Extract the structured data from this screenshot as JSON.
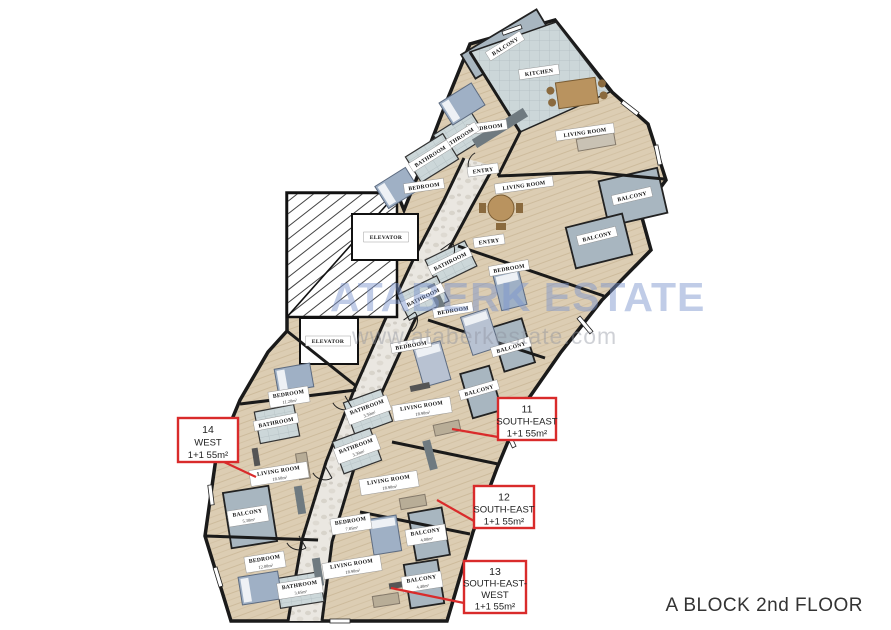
{
  "page": {
    "title": "A BLOCK 2nd FLOOR"
  },
  "watermark": {
    "line1": "ATABERK ESTATE",
    "line2": "www.ataberkestate.com"
  },
  "colors": {
    "annotation_red": "#d92b2b",
    "floor_wood": "#dccdb3",
    "balcony_gray": "#a8b6c0",
    "tile_gray": "#ccd7d9",
    "kitchen_gray": "#b9c4ca",
    "wall_black": "#1a1a1a",
    "watermark_blue": "#7c94cc"
  },
  "plan": {
    "rooms": [
      {
        "label": "BALCONY",
        "x": 505,
        "y": 46,
        "rot": -32
      },
      {
        "label": "KITCHEN",
        "x": 539,
        "y": 72,
        "rot": -8
      },
      {
        "label": "BEDROOM",
        "x": 487,
        "y": 127,
        "rot": -8
      },
      {
        "label": "BATHROOM",
        "x": 458,
        "y": 138,
        "rot": -32
      },
      {
        "label": "BATHROOM",
        "x": 430,
        "y": 156,
        "rot": -32
      },
      {
        "label": "LIVING ROOM",
        "x": 585,
        "y": 132,
        "rot": -8
      },
      {
        "label": "ENTRY",
        "x": 483,
        "y": 170,
        "rot": -8
      },
      {
        "label": "BEDROOM",
        "x": 424,
        "y": 186,
        "rot": -8
      },
      {
        "label": "LIVING ROOM",
        "x": 524,
        "y": 185,
        "rot": -8
      },
      {
        "label": "BALCONY",
        "x": 632,
        "y": 196,
        "rot": -13
      },
      {
        "label": "ELEVATOR",
        "x": 386,
        "y": 237,
        "rot": 0
      },
      {
        "label": "BALCONY",
        "x": 597,
        "y": 236,
        "rot": -14
      },
      {
        "label": "ENTRY",
        "x": 489,
        "y": 241,
        "rot": -8
      },
      {
        "label": "BATHROOM",
        "x": 450,
        "y": 261,
        "rot": -26
      },
      {
        "label": "BEDROOM",
        "x": 509,
        "y": 268,
        "rot": -10
      },
      {
        "label": "BATHROOM",
        "x": 423,
        "y": 297,
        "rot": -26
      },
      {
        "label": "BEDROOM",
        "x": 453,
        "y": 310,
        "rot": -10
      },
      {
        "label": "ELEVATOR",
        "x": 328,
        "y": 341,
        "rot": 0
      },
      {
        "label": "BEDROOM",
        "x": 411,
        "y": 345,
        "rot": -10
      },
      {
        "label": "BALCONY",
        "x": 511,
        "y": 347,
        "rot": -16
      },
      {
        "label": "BEDROOM",
        "area": "11.20m²",
        "x": 289,
        "y": 397,
        "rot": -9
      },
      {
        "label": "BALCONY",
        "x": 479,
        "y": 390,
        "rot": -16
      },
      {
        "label": "BATHROOM",
        "area": "3.50m²",
        "x": 368,
        "y": 410,
        "rot": -20
      },
      {
        "label": "LIVING ROOM",
        "area": "18.90m²",
        "x": 422,
        "y": 409,
        "rot": -9
      },
      {
        "label": "BATHROOM",
        "x": 276,
        "y": 422,
        "rot": -11
      },
      {
        "label": "BATHROOM",
        "area": "3.30m²",
        "x": 357,
        "y": 449,
        "rot": -20
      },
      {
        "label": "LIVING ROOM",
        "area": "18.50m²",
        "x": 279,
        "y": 474,
        "rot": -9
      },
      {
        "label": "LIVING ROOM",
        "area": "18.90m²",
        "x": 389,
        "y": 483,
        "rot": -9
      },
      {
        "label": "BALCONY",
        "area": "5.30m²",
        "x": 248,
        "y": 516,
        "rot": -9
      },
      {
        "label": "BEDROOM",
        "area": "7.85m²",
        "x": 351,
        "y": 524,
        "rot": -9
      },
      {
        "label": "BALCONY",
        "area": "4.00m²",
        "x": 426,
        "y": 535,
        "rot": -9
      },
      {
        "label": "BEDROOM",
        "area": "12.00m²",
        "x": 265,
        "y": 562,
        "rot": -9
      },
      {
        "label": "LIVING ROOM",
        "area": "18.90m²",
        "x": 352,
        "y": 567,
        "rot": -9
      },
      {
        "label": "BATHROOM",
        "area": "3.65m²",
        "x": 300,
        "y": 588,
        "rot": -9
      },
      {
        "label": "BALCONY",
        "area": "4.40m²",
        "x": 422,
        "y": 582,
        "rot": -9
      }
    ],
    "unit_labels": [
      {
        "lines": [
          "11",
          "SOUTH-EAST",
          "1+1 55m²"
        ],
        "x": 498,
        "y": 398,
        "w": 58,
        "h": 42,
        "leader": [
          [
            498,
            437
          ],
          [
            452,
            429
          ]
        ]
      },
      {
        "lines": [
          "12",
          "SOUTH-EAST",
          "1+1 55m²"
        ],
        "x": 474,
        "y": 486,
        "w": 60,
        "h": 42,
        "leader": [
          [
            474,
            521
          ],
          [
            437,
            500
          ]
        ]
      },
      {
        "lines": [
          "13",
          "SOUTH-EAST-",
          "WEST",
          "1+1 55m²"
        ],
        "x": 464,
        "y": 561,
        "w": 62,
        "h": 52,
        "leader": [
          [
            464,
            603
          ],
          [
            391,
            588
          ]
        ]
      },
      {
        "lines": [
          "14",
          "WEST",
          "1+1 55m²"
        ],
        "x": 178,
        "y": 418,
        "w": 60,
        "h": 44,
        "leader": [
          [
            224,
            462
          ],
          [
            256,
            477
          ]
        ]
      }
    ]
  }
}
